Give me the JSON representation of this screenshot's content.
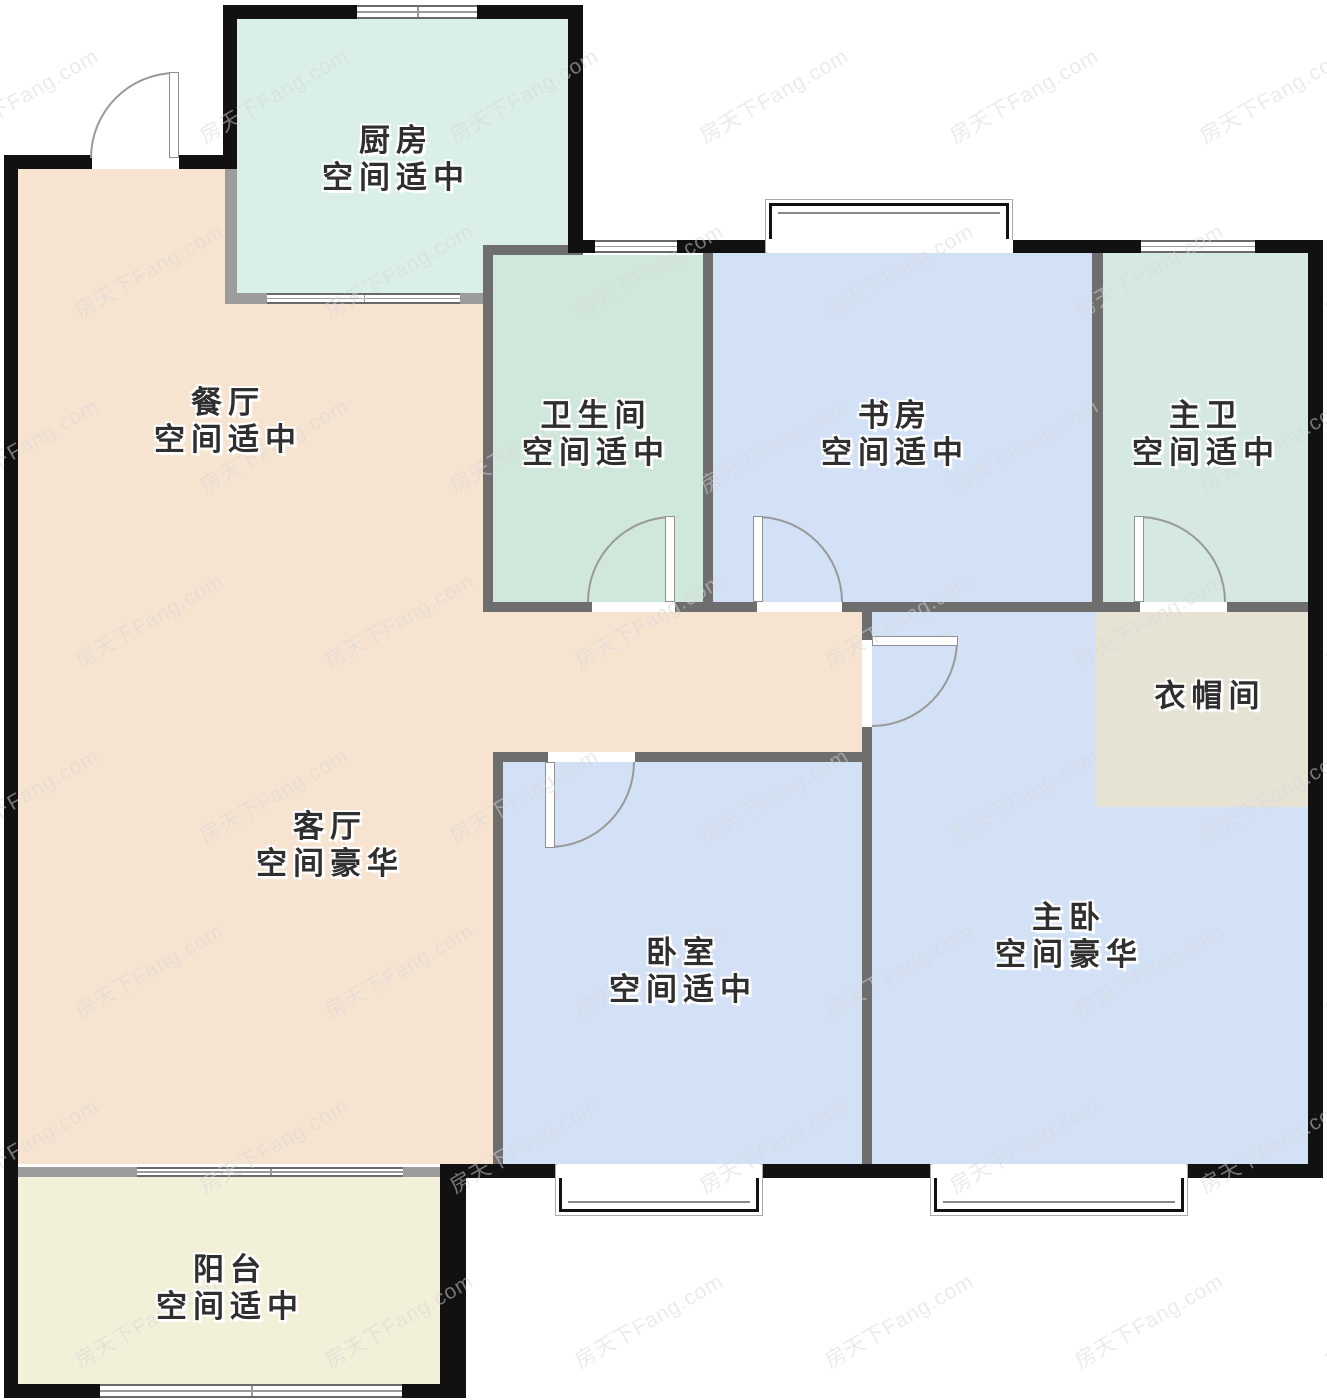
{
  "canvas": {
    "w": 1327,
    "h": 1400,
    "bg": "#ffffff"
  },
  "palette": {
    "wall_dark": "#111111",
    "wall_mid": "#6e6e6e",
    "wall_light": "#9c9c9c",
    "window_frame": "#6a6a6a",
    "window_line": "#9a9a9a",
    "door_arc": "#999999",
    "door_leaf_border": "#909090",
    "label_text": "#2f2f2f",
    "bay_frame": "#111111",
    "bay_outline": "#aaaaaa"
  },
  "watermark": {
    "text": "房天下Fang.com",
    "color": "#d8d8d8",
    "opacity": 0.5,
    "font_size": 21,
    "rotate_deg": -30,
    "x_start": -60,
    "y_start": 80,
    "x_step": 250,
    "y_step": 175,
    "row_stagger": 125,
    "rows": 8,
    "cols": 7
  },
  "rooms": [
    {
      "id": "kitchen",
      "name": "厨房",
      "note": "空间适中",
      "color": "#d9efe8",
      "label": {
        "cx": 396,
        "cy": 159
      },
      "rects": [
        [
          237,
          19,
          331,
          274
        ]
      ]
    },
    {
      "id": "dining",
      "name": "餐厅",
      "note": "空间适中",
      "color": "#f7e4d0",
      "label": {
        "cx": 228,
        "cy": 421
      },
      "rects": [
        [
          18,
          169,
          207,
          995
        ],
        [
          225,
          303,
          268,
          861
        ],
        [
          483,
          612,
          389,
          140
        ]
      ]
    },
    {
      "id": "living",
      "name": "客厅",
      "note": "空间豪华",
      "color": "#f7e4d0",
      "label": {
        "cx": 330,
        "cy": 845
      },
      "rects": []
    },
    {
      "id": "bathroom",
      "name": "卫生间",
      "note": "空间适中",
      "color": "#d0e7dc",
      "label": {
        "cx": 596,
        "cy": 434
      },
      "rects": [
        [
          493,
          255,
          210,
          347
        ]
      ]
    },
    {
      "id": "study",
      "name": "书房",
      "note": "空间适中",
      "color": "#d3e1f7",
      "label": {
        "cx": 895,
        "cy": 434
      },
      "rects": [
        [
          713,
          253,
          379,
          349
        ]
      ]
    },
    {
      "id": "master-bath",
      "name": "主卫",
      "note": "空间适中",
      "color": "#d5e9e1",
      "label": {
        "cx": 1206,
        "cy": 434
      },
      "rects": [
        [
          1103,
          253,
          205,
          349
        ]
      ]
    },
    {
      "id": "master-bedroom",
      "name": "主卧",
      "note": "空间豪华",
      "color": "#d3e1f7",
      "label": {
        "cx": 1069,
        "cy": 936
      },
      "rects": [
        [
          872,
          612,
          436,
          552
        ]
      ]
    },
    {
      "id": "closet",
      "name": "衣帽间",
      "note": "",
      "color": "#e6e3d4",
      "label": {
        "cx": 1210,
        "cy": 696
      },
      "rects": [
        [
          1095,
          612,
          213,
          195
        ]
      ]
    },
    {
      "id": "bedroom",
      "name": "卧室",
      "note": "空间适中",
      "color": "#d3e1f7",
      "label": {
        "cx": 683,
        "cy": 971
      },
      "rects": [
        [
          503,
          762,
          359,
          402
        ]
      ]
    },
    {
      "id": "balcony",
      "name": "阳台",
      "note": "空间适中",
      "color": "#f2f0d8",
      "label": {
        "cx": 230,
        "cy": 1288
      },
      "rects": [
        [
          18,
          1177,
          422,
          207
        ]
      ]
    }
  ],
  "walls": [
    {
      "id": "kitchen-left-lower-wall",
      "tone": "light",
      "x": 225,
      "y": 169,
      "w": 12,
      "h": 134
    },
    {
      "id": "kitchen-bottom-wall",
      "tone": "light",
      "x": 225,
      "y": 293,
      "w": 258,
      "h": 11
    },
    {
      "id": "living-balcony-wall",
      "tone": "light",
      "x": 18,
      "y": 1167,
      "w": 422,
      "h": 10
    },
    {
      "id": "bathroom-left-wall",
      "tone": "mid",
      "x": 483,
      "y": 245,
      "w": 10,
      "h": 357
    },
    {
      "id": "bathroom-top-wall",
      "tone": "mid",
      "x": 483,
      "y": 245,
      "w": 100,
      "h": 10
    },
    {
      "id": "bathroom-study-wall",
      "tone": "mid",
      "x": 703,
      "y": 253,
      "w": 10,
      "h": 349
    },
    {
      "id": "study-masterbath-wall",
      "tone": "mid",
      "x": 1092,
      "y": 253,
      "w": 11,
      "h": 359
    },
    {
      "id": "hallway-bottom-row-wall",
      "tone": "mid",
      "x": 483,
      "y": 602,
      "w": 825,
      "h": 10
    },
    {
      "id": "hallway-master-wall",
      "tone": "mid",
      "x": 862,
      "y": 612,
      "w": 10,
      "h": 552
    },
    {
      "id": "bedroom-top-wall",
      "tone": "mid",
      "x": 493,
      "y": 752,
      "w": 379,
      "h": 10
    },
    {
      "id": "bedroom-left-wall",
      "tone": "mid",
      "x": 493,
      "y": 752,
      "w": 10,
      "h": 412
    },
    {
      "id": "left-exterior-wall",
      "tone": "dark",
      "x": 4,
      "y": 155,
      "w": 14,
      "h": 1243
    },
    {
      "id": "entry-wall-left",
      "tone": "dark",
      "x": 4,
      "y": 155,
      "w": 88,
      "h": 14
    },
    {
      "id": "entry-wall-right",
      "tone": "dark",
      "x": 179,
      "y": 155,
      "w": 58,
      "h": 14
    },
    {
      "id": "kitchen-left-upper-wall",
      "tone": "dark",
      "x": 223,
      "y": 5,
      "w": 14,
      "h": 164
    },
    {
      "id": "kitchen-top-wall",
      "tone": "dark",
      "x": 223,
      "y": 5,
      "w": 360,
      "h": 14
    },
    {
      "id": "kitchen-right-wall",
      "tone": "dark",
      "x": 568,
      "y": 5,
      "w": 15,
      "h": 248
    },
    {
      "id": "main-top-wall",
      "tone": "dark",
      "x": 583,
      "y": 240,
      "w": 739,
      "h": 13
    },
    {
      "id": "right-exterior-wall",
      "tone": "dark",
      "x": 1308,
      "y": 240,
      "w": 15,
      "h": 938
    },
    {
      "id": "bottom-exterior-wall",
      "tone": "dark",
      "x": 440,
      "y": 1164,
      "w": 882,
      "h": 14
    },
    {
      "id": "balcony-right-wall",
      "tone": "dark",
      "x": 440,
      "y": 1178,
      "w": 26,
      "h": 220
    },
    {
      "id": "balcony-bottom-wall",
      "tone": "dark",
      "x": 4,
      "y": 1384,
      "w": 436,
      "h": 14
    }
  ],
  "windows": [
    {
      "id": "kitchen-top-window",
      "x": 357,
      "y": 5,
      "w": 120,
      "h": 14,
      "divider": true
    },
    {
      "id": "study-top-window",
      "x": 595,
      "y": 240,
      "w": 82,
      "h": 13,
      "divider": false
    },
    {
      "id": "masterbath-top-window",
      "x": 1141,
      "y": 240,
      "w": 114,
      "h": 13,
      "divider": false
    },
    {
      "id": "kitchen-bottom-window",
      "x": 267,
      "y": 293,
      "w": 193,
      "h": 11,
      "divider": true
    },
    {
      "id": "living-balcony-window",
      "x": 137,
      "y": 1167,
      "w": 266,
      "h": 10,
      "divider": true
    },
    {
      "id": "balcony-bottom-window",
      "x": 100,
      "y": 1384,
      "w": 302,
      "h": 14,
      "divider": true
    }
  ],
  "bay_windows": [
    {
      "id": "study-bay-window",
      "x": 765,
      "y": 199,
      "w": 248,
      "h": 54,
      "side": "top",
      "opening": [
        767,
        240,
        246,
        13
      ]
    },
    {
      "id": "bedroom-bay-window",
      "x": 555,
      "y": 1164,
      "w": 208,
      "h": 52,
      "side": "bottom",
      "opening": [
        557,
        1164,
        204,
        14
      ]
    },
    {
      "id": "master-bay-window",
      "x": 930,
      "y": 1164,
      "w": 258,
      "h": 52,
      "side": "bottom",
      "opening": [
        932,
        1164,
        254,
        14
      ]
    }
  ],
  "doors": [
    {
      "id": "entry-door",
      "opening": [
        92,
        155,
        87,
        14
      ],
      "leaf": [
        169,
        72,
        10,
        86
      ],
      "arc": [
        90,
        72,
        86,
        86
      ],
      "corner": "tl"
    },
    {
      "id": "bathroom-door",
      "opening": [
        592,
        602,
        83,
        10
      ],
      "leaf": [
        665,
        516,
        10,
        86
      ],
      "arc": [
        587,
        516,
        86,
        86
      ],
      "corner": "tl"
    },
    {
      "id": "study-door",
      "opening": [
        757,
        602,
        85,
        10
      ],
      "leaf": [
        753,
        516,
        10,
        86
      ],
      "arc": [
        757,
        516,
        86,
        86
      ],
      "corner": "tr"
    },
    {
      "id": "masterbath-door",
      "opening": [
        1140,
        602,
        87,
        10
      ],
      "leaf": [
        1134,
        516,
        10,
        86
      ],
      "arc": [
        1138,
        516,
        88,
        86
      ],
      "corner": "tr"
    },
    {
      "id": "master-bedroom-door",
      "opening": [
        862,
        640,
        10,
        87
      ],
      "leaf": [
        872,
        636,
        86,
        10
      ],
      "arc": [
        872,
        640,
        86,
        87
      ],
      "corner": "br"
    },
    {
      "id": "bedroom-door",
      "opening": [
        548,
        752,
        87,
        10
      ],
      "leaf": [
        545,
        762,
        10,
        86
      ],
      "arc": [
        549,
        762,
        86,
        86
      ],
      "corner": "br"
    }
  ]
}
